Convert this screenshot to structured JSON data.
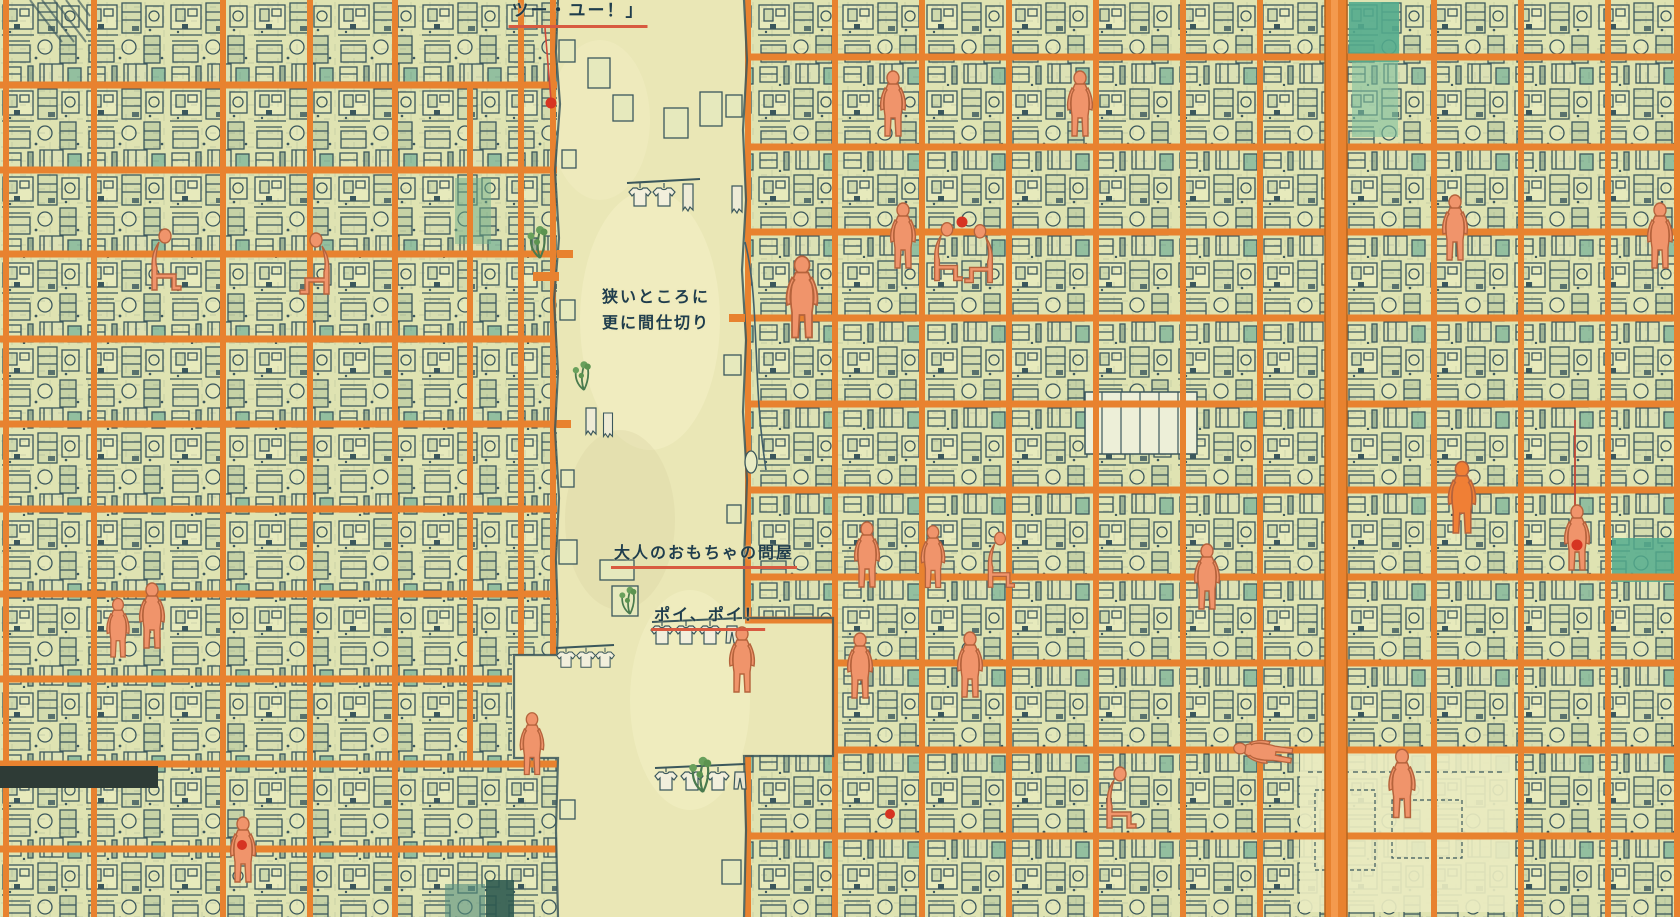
{
  "annotations": {
    "quote_top": {
      "text": "ツー・ユー！」"
    },
    "partition_note": {
      "line1": "狭いところに",
      "line2": "更に間仕切り"
    },
    "adult_toy_wholesaler": {
      "text": "大人のおもちゃの問屋"
    },
    "poi_poi": {
      "text": "ポイ、ポイ！"
    }
  },
  "palette": {
    "paper_alley": "#eae7b6",
    "room_base": "#dfe3b2",
    "line_ink": "#3b575c",
    "structure_orange": "#e8822f",
    "structure_orange_dark": "#b5641e",
    "figure_skin": "#f0946b",
    "figure_outline": "#b5633c",
    "accent_red_dot": "#d63422",
    "underline_red": "#d85a40",
    "teal_accent": "#53ab8d",
    "annotation_text": "#1f3d4d"
  },
  "shapes": {
    "person_figure": "orange human silhouette",
    "red_marker_dot": "●",
    "laundry_shirt": "hanging shirt outline",
    "laundry_pants": "hanging pants outline",
    "laundry_towel": "hanging towel outline",
    "plant": "green foliage sprigs",
    "clothes_pole": "horizontal laundry pole",
    "structural_column": "orange vertical beam",
    "floor_slab": "orange horizontal beam"
  }
}
